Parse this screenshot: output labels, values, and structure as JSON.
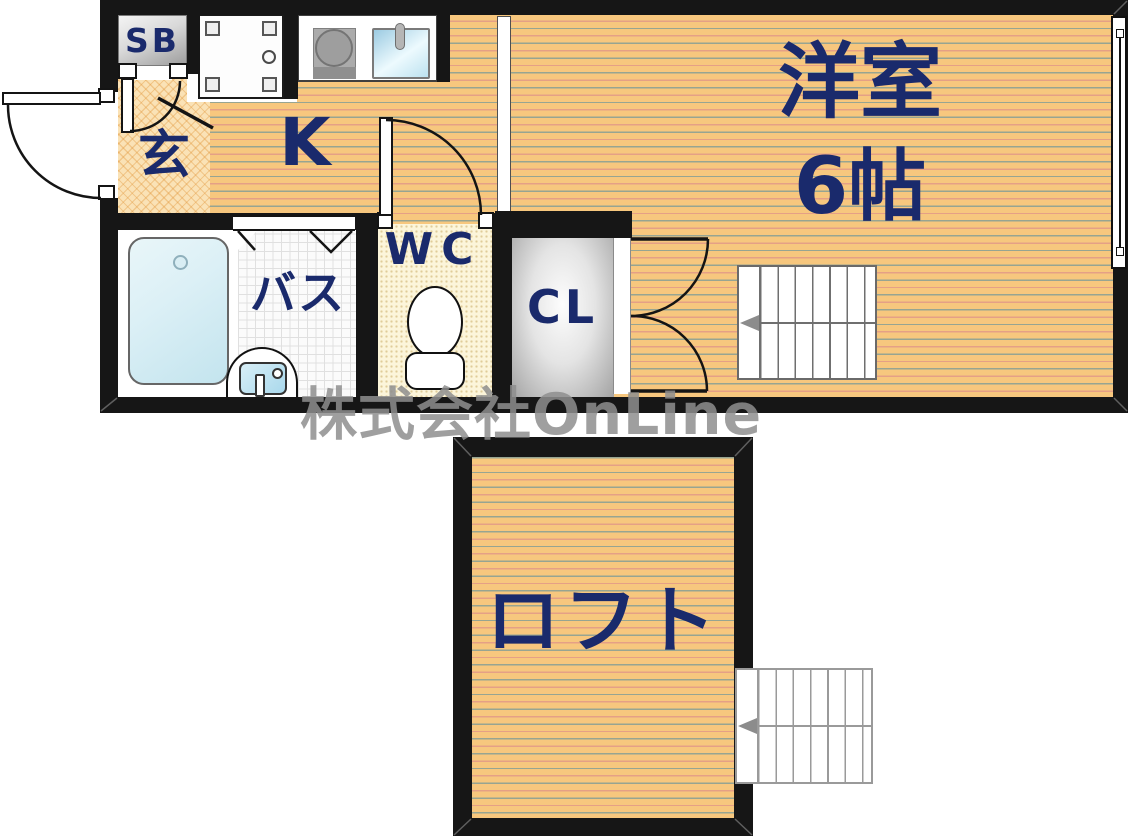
{
  "floorplan": {
    "description": "Japanese 1K apartment floor plan with loft",
    "labels": {
      "shoe_box": "SB",
      "entrance": "玄",
      "kitchen": "K",
      "toilet": "WC",
      "bath": "バス",
      "closet": "CL",
      "western_room": "洋室",
      "western_room_size": "6帖",
      "loft": "ロフト"
    },
    "watermark": "株式会社OnLine",
    "rooms": [
      {
        "name": "entrance",
        "label": "玄"
      },
      {
        "name": "kitchen",
        "label": "K"
      },
      {
        "name": "western-room",
        "label": "洋室 6帖"
      },
      {
        "name": "bath",
        "label": "バス"
      },
      {
        "name": "toilet",
        "label": "WC"
      },
      {
        "name": "closet",
        "label": "CL"
      },
      {
        "name": "shoe-box",
        "label": "SB"
      },
      {
        "name": "loft",
        "label": "ロフト"
      }
    ],
    "colors": {
      "wall": "#161616",
      "label_navy": "#1A2A6C",
      "wood_floor": "#F7C77E",
      "entrance_tile": "#FAE2B6",
      "wc_floor": "#FCF5DA",
      "tub_blue": "#C3E4EE",
      "closet_gray": "#A2A2A2",
      "watermark_gray": "#8E8E8E"
    }
  }
}
